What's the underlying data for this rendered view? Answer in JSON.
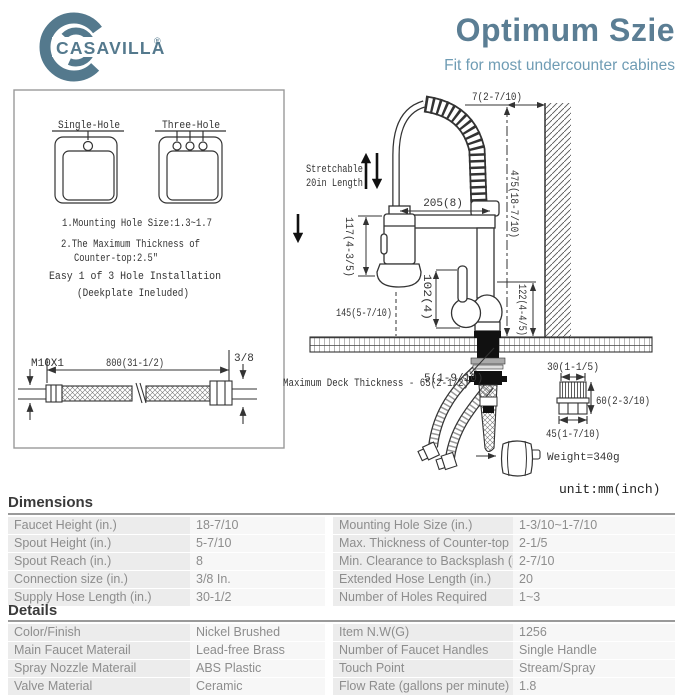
{
  "brand": {
    "name": "CASAVILLA",
    "registered": "®"
  },
  "header": {
    "title": "Optimum Szie",
    "subtitle": "Fit for most undercounter cabines"
  },
  "install_box": {
    "single_hole_label": "Single-Hole",
    "three_hole_label": "Three-Hole",
    "notes": [
      "1.Mounting Hole Size:1.3~1.7",
      "2.The Maximum Thickness of",
      "Counter-top:2.5\"",
      "Easy 1 of 3 Hole Installation",
      "(Deekplate Ineluded)"
    ],
    "hose": {
      "thread_left": "M10X1",
      "length": "800(31-1/2)",
      "thread_right": "3/8"
    }
  },
  "diagram": {
    "stretch_line1": "Stretchable",
    "stretch_line2": "20in Length",
    "dim_top": "7(2-7/10)",
    "dim_reach": "205(8)",
    "dim_height": "475(18-7/10)",
    "dim_spray_head": "117(4-3/5)",
    "dim_handle": "102(4)",
    "dim_body": "122(4-4/5)",
    "dim_clearance": "145(5-7/10)",
    "dim_deck_hole": "5(1-9/10)",
    "deck_thickness": "Maximum Deck Thickness - 65(2-1/2)",
    "weight": "Weight=340g",
    "aerator_top": "30(1-1/5)",
    "aerator_height": "60(2-3/10)",
    "aerator_bottom": "45(1-7/10)",
    "unit_note": "unit:mm(inch)"
  },
  "dimensions_table": {
    "title": "Dimensions",
    "rows": [
      [
        "Faucet Height (in.)",
        "18-7/10",
        "Mounting Hole Size (in.)",
        "1-3/10~1-7/10"
      ],
      [
        "Spout Height (in.)",
        "5-7/10",
        "Max. Thickness of Counter-top (in.)",
        "2-1/5"
      ],
      [
        "Spout Reach (in.)",
        "8",
        "Min. Clearance to Backsplash (in.)",
        "2-7/10"
      ],
      [
        "Connection size (in.)",
        "3/8 In.",
        "Extended Hose Length (in.)",
        "20"
      ],
      [
        "Supply Hose Length (in.)",
        "30-1/2",
        "Number of Holes Required",
        "1~3"
      ]
    ]
  },
  "details_table": {
    "title": "Details",
    "rows": [
      [
        "Color/Finish",
        "Nickel Brushed",
        "Item N.W(G)",
        "1256"
      ],
      [
        "Main Faucet Materail",
        "Lead-free Brass",
        "Number of Faucet Handles",
        "Single Handle"
      ],
      [
        "Spray Nozzle Materail",
        "ABS Plastic",
        "Touch Point",
        "Stream/Spray"
      ],
      [
        "Valve Material",
        "Ceramic",
        "Flow Rate (gallons per minute)",
        "1.8"
      ]
    ]
  }
}
